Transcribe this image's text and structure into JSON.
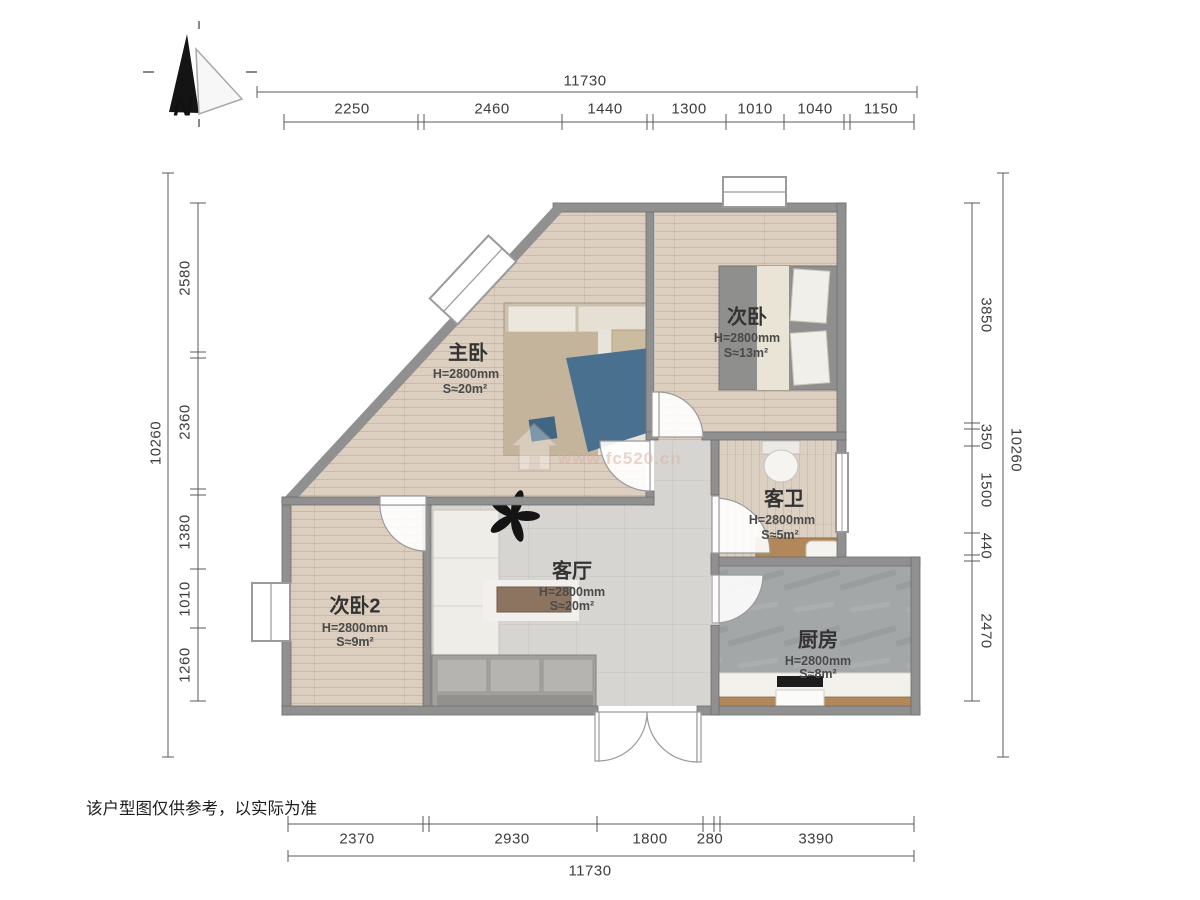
{
  "title": "户型图",
  "north_indicator": {
    "label": "N"
  },
  "dimensions": {
    "top": {
      "total": "11730",
      "segments": [
        "2250",
        "2460",
        "1440",
        "1300",
        "1010",
        "1040",
        "1150"
      ]
    },
    "bottom": {
      "total": "11730",
      "segments": [
        "2370",
        "2930",
        "1800",
        "280",
        "3390"
      ]
    },
    "left": {
      "total": "10260",
      "segments": [
        "2580",
        "2360",
        "1380",
        "1010",
        "1260"
      ]
    },
    "right": {
      "total": "10260",
      "segments": [
        "3850",
        "350",
        "1500",
        "440",
        "2470"
      ]
    }
  },
  "rooms": [
    {
      "name": "主卧",
      "height": "H=2800mm",
      "area": "S≈20m²"
    },
    {
      "name": "次卧",
      "height": "H=2800mm",
      "area": "S≈13m²"
    },
    {
      "name": "客卫",
      "height": "H=2800mm",
      "area": "S≈5m²"
    },
    {
      "name": "客厅",
      "height": "H=2800mm",
      "area": "S≈20m²"
    },
    {
      "name": "次卧2",
      "height": "H=2800mm",
      "area": "S≈9m²"
    },
    {
      "name": "厨房",
      "height": "H=2800mm",
      "area": "S≈8m²"
    }
  ],
  "watermark": {
    "url": "www.fc520.cn"
  },
  "disclaimer": "该户型图仅供参考，以实际为准",
  "colors": {
    "wall": "#909090",
    "wood_floor": "#dccfbf",
    "tile_floor": "#d7d5d1",
    "kitchen_floor": "#a4a7a8",
    "cabinet_brown": "#b2885a",
    "blanket_blue": "#49708e"
  }
}
